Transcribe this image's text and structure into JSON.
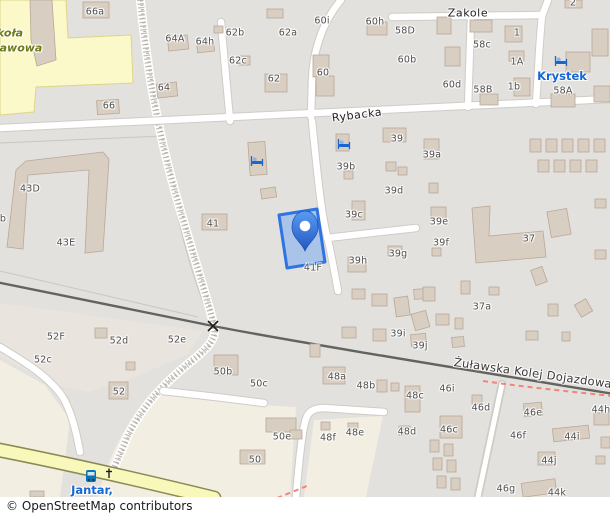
{
  "attribution": "© OpenStreetMap contributors",
  "colors": {
    "base-gray": "#e3e1dd",
    "parcel-beige": "#e9e4de",
    "farmland-cream": "#f3eee2",
    "school-yellow": "#fbf8c9",
    "school-border": "#dcd687",
    "school-text": "#6e7b17",
    "road-fill": "#ffffff",
    "road-casing": "#cfccc6",
    "yellow-road": "#f8f8bb",
    "yellow-road-casing": "#8a8a55",
    "railway": "#63635f",
    "footway-pink": "#f4837a",
    "building-fill": "#d9cec2",
    "building-stroke": "#b9a898",
    "selected-fill": "#a9c3e9",
    "selected-stroke": "#2e74e3",
    "pin-top": "#5b9bf2",
    "pin-bottom": "#2257c5",
    "poi-blue": "#1767d2"
  },
  "map": {
    "street_labels": [
      {
        "text": "Zakole",
        "x": 468,
        "y": 13,
        "rot": 0,
        "cls": "street"
      },
      {
        "text": "Rybacka",
        "x": 357,
        "y": 115,
        "rot": -7,
        "cls": "street"
      },
      {
        "text": "Żuławska Kolej Dojazdowa",
        "x": 533,
        "y": 373,
        "rot": 8,
        "cls": "rail-name"
      }
    ],
    "poi_labels": [
      {
        "text": "Krystek",
        "x": 562,
        "y": 76
      },
      {
        "text": "Jantar,",
        "x": 92,
        "y": 490
      }
    ],
    "school_label": [
      {
        "text": "koła",
        "x": 10,
        "y": 33
      },
      {
        "text": "awowa",
        "x": 21,
        "y": 48
      }
    ],
    "housenumbers": [
      {
        "text": "66a",
        "x": 95,
        "y": 12
      },
      {
        "text": "64A",
        "x": 175,
        "y": 39
      },
      {
        "text": "64h",
        "x": 205,
        "y": 42
      },
      {
        "text": "62b",
        "x": 235,
        "y": 33
      },
      {
        "text": "62a",
        "x": 288,
        "y": 33
      },
      {
        "text": "62c",
        "x": 238,
        "y": 61
      },
      {
        "text": "62",
        "x": 274,
        "y": 79
      },
      {
        "text": "64",
        "x": 164,
        "y": 88
      },
      {
        "text": "66",
        "x": 109,
        "y": 106
      },
      {
        "text": "60i",
        "x": 322,
        "y": 21
      },
      {
        "text": "60h",
        "x": 375,
        "y": 22
      },
      {
        "text": "58D",
        "x": 405,
        "y": 31
      },
      {
        "text": "58c",
        "x": 482,
        "y": 45
      },
      {
        "text": "1",
        "x": 517,
        "y": 33
      },
      {
        "text": "1A",
        "x": 517,
        "y": 62
      },
      {
        "text": "1b",
        "x": 514,
        "y": 87
      },
      {
        "text": "58B",
        "x": 483,
        "y": 90
      },
      {
        "text": "60",
        "x": 323,
        "y": 73
      },
      {
        "text": "60b",
        "x": 407,
        "y": 60
      },
      {
        "text": "60d",
        "x": 452,
        "y": 85
      },
      {
        "text": "58A",
        "x": 563,
        "y": 91
      },
      {
        "text": "2",
        "x": 573,
        "y": 3
      },
      {
        "text": "43D",
        "x": 30,
        "y": 189
      },
      {
        "text": "43E",
        "x": 66,
        "y": 243
      },
      {
        "text": "b",
        "x": 3,
        "y": 219
      },
      {
        "text": "41",
        "x": 213,
        "y": 224
      },
      {
        "text": "39",
        "x": 397,
        "y": 139
      },
      {
        "text": "39a",
        "x": 432,
        "y": 155
      },
      {
        "text": "39b",
        "x": 346,
        "y": 167
      },
      {
        "text": "39d",
        "x": 394,
        "y": 191
      },
      {
        "text": "39c",
        "x": 354,
        "y": 215
      },
      {
        "text": "39e",
        "x": 439,
        "y": 222
      },
      {
        "text": "39f",
        "x": 441,
        "y": 243
      },
      {
        "text": "39g",
        "x": 398,
        "y": 254
      },
      {
        "text": "39h",
        "x": 358,
        "y": 261
      },
      {
        "text": "37",
        "x": 529,
        "y": 239
      },
      {
        "text": "41F",
        "x": 313,
        "y": 268
      },
      {
        "text": "37a",
        "x": 482,
        "y": 307
      },
      {
        "text": "39i",
        "x": 398,
        "y": 334
      },
      {
        "text": "39j",
        "x": 420,
        "y": 346
      },
      {
        "text": "52F",
        "x": 56,
        "y": 337
      },
      {
        "text": "52d",
        "x": 119,
        "y": 341
      },
      {
        "text": "52e",
        "x": 177,
        "y": 340
      },
      {
        "text": "52c",
        "x": 43,
        "y": 360
      },
      {
        "text": "52",
        "x": 119,
        "y": 392
      },
      {
        "text": "50b",
        "x": 223,
        "y": 372
      },
      {
        "text": "50c",
        "x": 259,
        "y": 384
      },
      {
        "text": "48a",
        "x": 337,
        "y": 377
      },
      {
        "text": "48b",
        "x": 366,
        "y": 386
      },
      {
        "text": "48c",
        "x": 415,
        "y": 396
      },
      {
        "text": "50e",
        "x": 282,
        "y": 437
      },
      {
        "text": "48f",
        "x": 328,
        "y": 438
      },
      {
        "text": "48e",
        "x": 355,
        "y": 433
      },
      {
        "text": "48d",
        "x": 407,
        "y": 432
      },
      {
        "text": "50",
        "x": 255,
        "y": 460
      },
      {
        "text": "46i",
        "x": 447,
        "y": 389
      },
      {
        "text": "46d",
        "x": 481,
        "y": 408
      },
      {
        "text": "46e",
        "x": 533,
        "y": 413
      },
      {
        "text": "44h",
        "x": 601,
        "y": 410
      },
      {
        "text": "46c",
        "x": 449,
        "y": 430
      },
      {
        "text": "46f",
        "x": 518,
        "y": 436
      },
      {
        "text": "44i",
        "x": 572,
        "y": 437
      },
      {
        "text": "44j",
        "x": 549,
        "y": 461
      },
      {
        "text": "46g",
        "x": 506,
        "y": 489
      },
      {
        "text": "44k",
        "x": 557,
        "y": 493
      }
    ],
    "selected_building_label": "41F",
    "buildings": [
      [
        83,
        2,
        26,
        16,
        0
      ],
      [
        267,
        9,
        16,
        9,
        0
      ],
      [
        214,
        26,
        9,
        7,
        0
      ],
      [
        168,
        36,
        20,
        14,
        -6
      ],
      [
        197,
        40,
        17,
        12,
        -6
      ],
      [
        239,
        56,
        11,
        9,
        0
      ],
      [
        265,
        74,
        22,
        18,
        0
      ],
      [
        157,
        83,
        20,
        14,
        -6
      ],
      [
        97,
        100,
        22,
        14,
        -4
      ],
      [
        367,
        22,
        20,
        13,
        0
      ],
      [
        437,
        17,
        14,
        17,
        0
      ],
      [
        470,
        20,
        22,
        12,
        0
      ],
      [
        505,
        26,
        17,
        16,
        0
      ],
      [
        313,
        55,
        16,
        22,
        0
      ],
      [
        316,
        76,
        18,
        20,
        0
      ],
      [
        445,
        47,
        15,
        19,
        0
      ],
      [
        509,
        51,
        15,
        10,
        0
      ],
      [
        514,
        78,
        16,
        18,
        0
      ],
      [
        480,
        94,
        18,
        11,
        0
      ],
      [
        566,
        52,
        24,
        20,
        0
      ],
      [
        551,
        94,
        24,
        13,
        0
      ],
      [
        592,
        29,
        16,
        27,
        0
      ],
      [
        565,
        0,
        17,
        8,
        0
      ],
      [
        594,
        86,
        16,
        16,
        0
      ],
      [
        249,
        142,
        17,
        33,
        -4
      ],
      [
        261,
        188,
        15,
        10,
        -8
      ],
      [
        202,
        214,
        25,
        16,
        0
      ],
      [
        383,
        128,
        23,
        14,
        0
      ],
      [
        424,
        139,
        15,
        20,
        0
      ],
      [
        336,
        134,
        13,
        17,
        0
      ],
      [
        344,
        171,
        9,
        8,
        0
      ],
      [
        386,
        162,
        10,
        9,
        0
      ],
      [
        398,
        167,
        9,
        8,
        0
      ],
      [
        429,
        183,
        9,
        10,
        0
      ],
      [
        352,
        201,
        13,
        19,
        0
      ],
      [
        431,
        207,
        15,
        13,
        0
      ],
      [
        432,
        248,
        9,
        8,
        0
      ],
      [
        348,
        257,
        18,
        15,
        0
      ],
      [
        388,
        246,
        14,
        10,
        0
      ],
      [
        549,
        210,
        20,
        26,
        -10
      ],
      [
        595,
        199,
        11,
        9,
        0
      ],
      [
        595,
        250,
        11,
        9,
        0
      ],
      [
        530,
        139,
        11,
        13,
        0
      ],
      [
        546,
        139,
        11,
        13,
        0
      ],
      [
        562,
        139,
        11,
        13,
        0
      ],
      [
        578,
        139,
        11,
        13,
        0
      ],
      [
        594,
        139,
        11,
        13,
        0
      ],
      [
        538,
        160,
        11,
        12,
        0
      ],
      [
        554,
        160,
        11,
        12,
        0
      ],
      [
        570,
        160,
        11,
        12,
        0
      ],
      [
        586,
        160,
        11,
        12,
        0
      ],
      [
        414,
        289,
        12,
        10,
        -5
      ],
      [
        461,
        281,
        9,
        13,
        0
      ],
      [
        489,
        287,
        10,
        8,
        0
      ],
      [
        533,
        268,
        12,
        16,
        -20
      ],
      [
        548,
        304,
        10,
        12,
        0
      ],
      [
        577,
        301,
        13,
        14,
        -30
      ],
      [
        526,
        331,
        12,
        9,
        0
      ],
      [
        562,
        332,
        8,
        9,
        0
      ],
      [
        352,
        289,
        13,
        10,
        0
      ],
      [
        372,
        294,
        15,
        12,
        0
      ],
      [
        395,
        297,
        14,
        19,
        -8
      ],
      [
        423,
        287,
        12,
        14,
        0
      ],
      [
        413,
        312,
        15,
        17,
        -15
      ],
      [
        436,
        314,
        13,
        11,
        0
      ],
      [
        342,
        327,
        14,
        11,
        0
      ],
      [
        373,
        329,
        13,
        12,
        0
      ],
      [
        411,
        334,
        15,
        12,
        -5
      ],
      [
        455,
        318,
        8,
        11,
        0
      ],
      [
        452,
        337,
        12,
        10,
        -5
      ],
      [
        95,
        328,
        12,
        10,
        0
      ],
      [
        126,
        362,
        9,
        8,
        0
      ],
      [
        109,
        382,
        19,
        17,
        0
      ],
      [
        214,
        355,
        24,
        20,
        0
      ],
      [
        266,
        418,
        30,
        14,
        0
      ],
      [
        290,
        430,
        12,
        9,
        0
      ],
      [
        240,
        450,
        25,
        14,
        0
      ],
      [
        323,
        367,
        22,
        17,
        0
      ],
      [
        377,
        380,
        10,
        12,
        0
      ],
      [
        391,
        383,
        8,
        8,
        0
      ],
      [
        405,
        386,
        15,
        26,
        0
      ],
      [
        310,
        344,
        10,
        13,
        0
      ],
      [
        321,
        422,
        9,
        8,
        0
      ],
      [
        348,
        423,
        10,
        9,
        0
      ],
      [
        399,
        426,
        11,
        9,
        0
      ],
      [
        440,
        416,
        22,
        22,
        0
      ],
      [
        472,
        395,
        10,
        9,
        0
      ],
      [
        524,
        403,
        18,
        13,
        -5
      ],
      [
        553,
        427,
        36,
        13,
        -6
      ],
      [
        538,
        452,
        17,
        13,
        0
      ],
      [
        522,
        481,
        34,
        14,
        -8
      ],
      [
        594,
        413,
        15,
        12,
        0
      ],
      [
        601,
        437,
        9,
        11,
        0
      ],
      [
        596,
        456,
        9,
        8,
        0
      ],
      [
        430,
        440,
        9,
        12,
        0
      ],
      [
        444,
        444,
        9,
        12,
        0
      ],
      [
        433,
        458,
        9,
        12,
        0
      ],
      [
        447,
        460,
        9,
        12,
        0
      ],
      [
        437,
        476,
        9,
        12,
        0
      ],
      [
        451,
        478,
        9,
        12,
        0
      ],
      [
        30,
        491,
        14,
        6,
        0
      ]
    ],
    "building_polygons": [
      "16,170 26,161 103,152 109,159 103,251 85,253 89,170 28,175 23,249 7,247",
      "472,208 490,206 489,236 543,231 546,257 476,263",
      "30,0 52,0 56,60 37,66 31,40"
    ],
    "selected_polygon": "279,215 317,209 325,262 287,268"
  }
}
